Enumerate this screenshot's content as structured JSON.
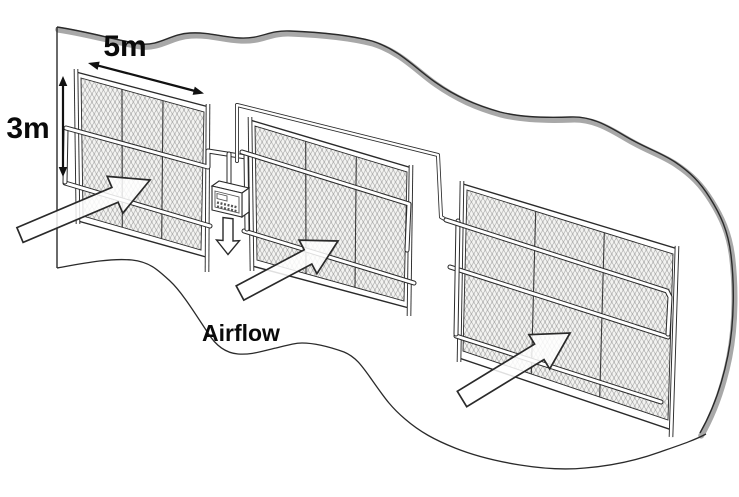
{
  "diagram": {
    "type": "technical-illustration",
    "subject": "fog-collector-mesh-panels",
    "labels": {
      "width_dimension": "5m",
      "height_dimension": "3m",
      "airflow": "Airflow"
    },
    "elements": {
      "mesh_panel_count": 3,
      "airflow_arrow_count": 3,
      "has_flow_device": true,
      "has_device_outflow_arrow": true
    },
    "colors": {
      "background": "#ffffff",
      "line": "#2a2a2a",
      "ridge_shadow": "#a8a8a8",
      "mesh_texture": "#9b9b9b"
    }
  }
}
